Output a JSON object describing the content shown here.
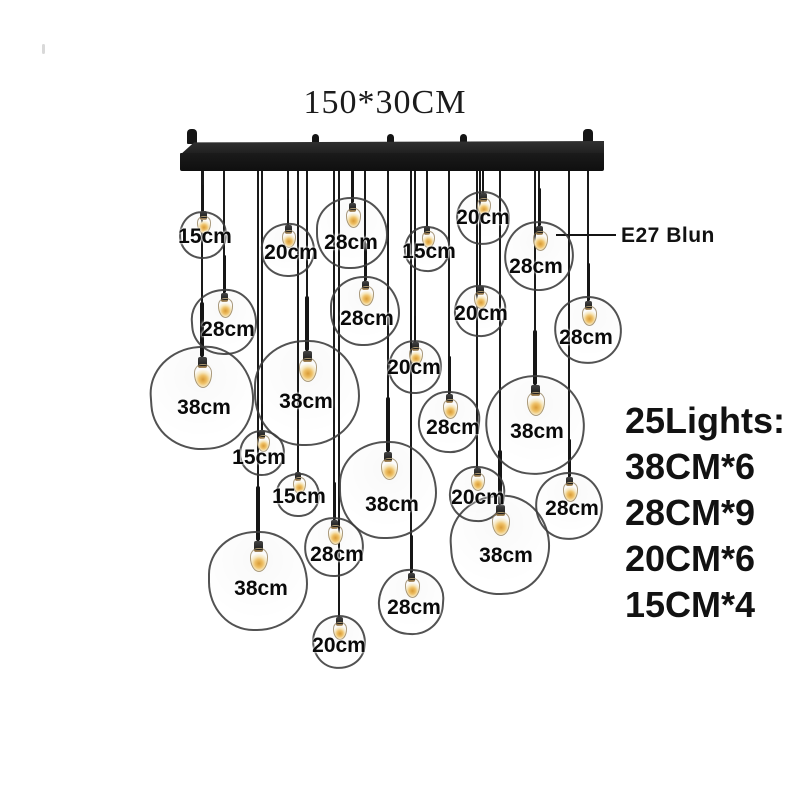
{
  "title": "150*30CM",
  "e27": {
    "label": "E27 Blun"
  },
  "summary": {
    "title": "25Lights:",
    "lines": [
      "38CM*6",
      "28CM*9",
      "20CM*6",
      "15CM*4"
    ]
  },
  "colors": {
    "background": "#ffffff",
    "text": "#121212",
    "bar": "#141414",
    "cord": "#1a1a1a",
    "globe_stroke": "#3a3a3a",
    "bulb_glow": "#eec066"
  },
  "bar": {
    "label": "150*30CM",
    "bottom_y": 168,
    "knobs": [
      {
        "x": 192,
        "end": true
      },
      {
        "x": 315,
        "end": false
      },
      {
        "x": 390,
        "end": false
      },
      {
        "x": 463,
        "end": false
      },
      {
        "x": 588,
        "end": true
      }
    ]
  },
  "fixtures": {
    "count_total": 25,
    "items": [
      {
        "label": "15cm",
        "cx": 203,
        "cy": 235,
        "r": 24,
        "label_x": 205,
        "label_y": 237
      },
      {
        "label": "20cm",
        "cx": 288,
        "cy": 250,
        "r": 27,
        "label_x": 291,
        "label_y": 253
      },
      {
        "label": "28cm",
        "cx": 352,
        "cy": 233,
        "r": 36,
        "label_x": 351,
        "label_y": 243
      },
      {
        "label": "15cm",
        "cx": 427,
        "cy": 249,
        "r": 23,
        "label_x": 429,
        "label_y": 252
      },
      {
        "label": "20cm",
        "cx": 483,
        "cy": 218,
        "r": 27,
        "label_x": 483,
        "label_y": 218
      },
      {
        "label": "28cm",
        "cx": 539,
        "cy": 256,
        "r": 35,
        "label_x": 536,
        "label_y": 267
      },
      {
        "label": "28cm",
        "cx": 224,
        "cy": 322,
        "r": 33,
        "label_x": 228,
        "label_y": 330
      },
      {
        "label": "28cm",
        "cx": 365,
        "cy": 311,
        "r": 35,
        "label_x": 367,
        "label_y": 319
      },
      {
        "label": "20cm",
        "cx": 480,
        "cy": 311,
        "r": 26,
        "label_x": 481,
        "label_y": 314
      },
      {
        "label": "28cm",
        "cx": 588,
        "cy": 330,
        "r": 34,
        "label_x": 586,
        "label_y": 338
      },
      {
        "label": "20cm",
        "cx": 415,
        "cy": 367,
        "r": 27,
        "label_x": 414,
        "label_y": 368
      },
      {
        "label": "38cm",
        "cx": 202,
        "cy": 398,
        "r": 52,
        "label_x": 204,
        "label_y": 408
      },
      {
        "label": "38cm",
        "cx": 307,
        "cy": 393,
        "r": 53,
        "label_x": 306,
        "label_y": 402
      },
      {
        "label": "28cm",
        "cx": 449,
        "cy": 422,
        "r": 31,
        "label_x": 453,
        "label_y": 428
      },
      {
        "label": "38cm",
        "cx": 535,
        "cy": 425,
        "r": 50,
        "label_x": 537,
        "label_y": 432
      },
      {
        "label": "15cm",
        "cx": 262,
        "cy": 453,
        "r": 23,
        "label_x": 259,
        "label_y": 458
      },
      {
        "label": "15cm",
        "cx": 298,
        "cy": 495,
        "r": 22,
        "label_x": 299,
        "label_y": 497
      },
      {
        "label": "38cm",
        "cx": 388,
        "cy": 490,
        "r": 49,
        "label_x": 392,
        "label_y": 505
      },
      {
        "label": "20cm",
        "cx": 477,
        "cy": 494,
        "r": 28,
        "label_x": 478,
        "label_y": 498
      },
      {
        "label": "28cm",
        "cx": 569,
        "cy": 506,
        "r": 34,
        "label_x": 572,
        "label_y": 509
      },
      {
        "label": "28cm",
        "cx": 334,
        "cy": 547,
        "r": 30,
        "label_x": 337,
        "label_y": 555
      },
      {
        "label": "38cm",
        "cx": 500,
        "cy": 545,
        "r": 50,
        "label_x": 506,
        "label_y": 556
      },
      {
        "label": "38cm",
        "cx": 258,
        "cy": 581,
        "r": 50,
        "label_x": 261,
        "label_y": 589
      },
      {
        "label": "28cm",
        "cx": 411,
        "cy": 602,
        "r": 33,
        "label_x": 414,
        "label_y": 608
      },
      {
        "label": "20cm",
        "cx": 339,
        "cy": 642,
        "r": 27,
        "label_x": 339,
        "label_y": 646
      }
    ]
  }
}
